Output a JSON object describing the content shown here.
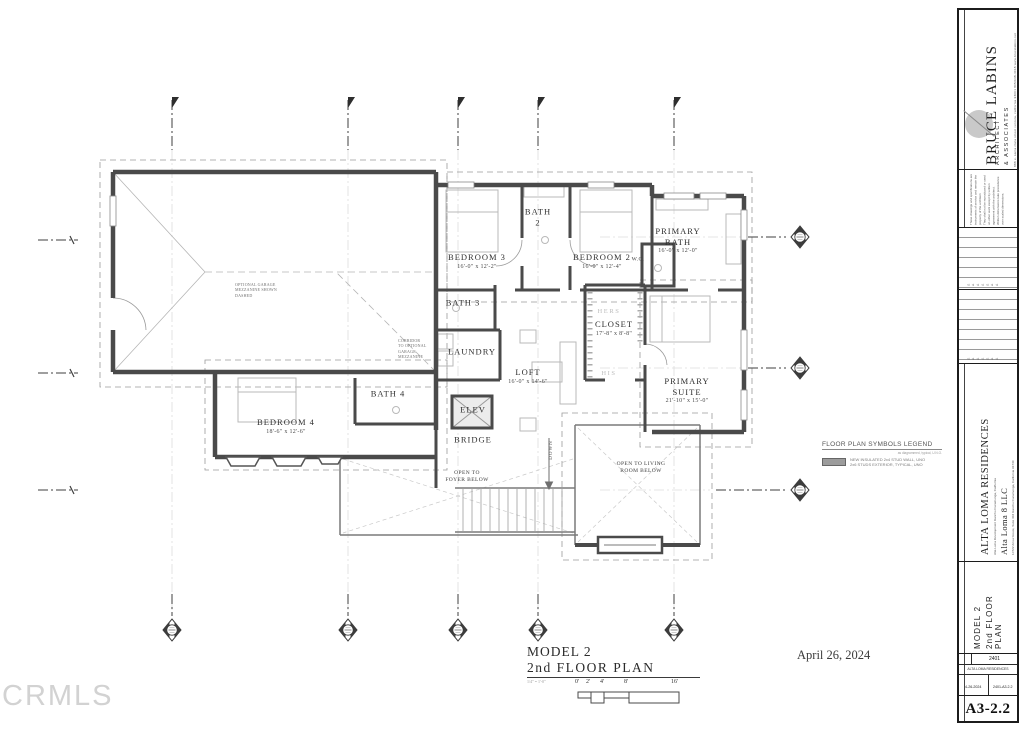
{
  "watermark": "CRMLS",
  "date_note": "April 26, 2024",
  "drawing_title": {
    "line1": "MODEL 2",
    "line2": "2nd FLOOR PLAN",
    "scale_note": "1/4\" = 1'-0\"",
    "scale_ticks": [
      "0'",
      "2'",
      "4'",
      "8'",
      "16'"
    ]
  },
  "legend": {
    "title": "FLOOR PLAN SYMBOLS LEGEND",
    "note": "as diagrammed, typical, U.N.O.",
    "items": [
      {
        "symbol": "wall-swatch",
        "desc": "NEW INSULATED 2x4 STUD WALL, UNO\n2x6 STUDS EXTERIOR, TYPICAL, UNO"
      }
    ]
  },
  "plan": {
    "rooms": [
      {
        "label": "BEDROOM  3",
        "dims": "16'-0\" x 12'-2\""
      },
      {
        "label": "BATH\n2"
      },
      {
        "label": "BEDROOM  2",
        "dims": "16'-0\" x 12'-4\""
      },
      {
        "label": "PRIMARY\nBATH",
        "dims": "16'-0\" x 12'-0\""
      },
      {
        "label": "W.C."
      },
      {
        "label": "BATH  3"
      },
      {
        "label": "LAUNDRY"
      },
      {
        "label": "HERS"
      },
      {
        "label": "CLOSET",
        "dims": "17'-8\" x 8'-8\""
      },
      {
        "label": "HIS"
      },
      {
        "label": "LOFT",
        "dims": "16'-0\" x 14'-6\""
      },
      {
        "label": "PRIMARY\nSUITE",
        "dims": "21'-10\" x 15'-0\""
      },
      {
        "label": "BEDROOM  4",
        "dims": "18'-6\" x 12'-6\""
      },
      {
        "label": "BATH  4"
      },
      {
        "label": "ELEV"
      },
      {
        "label": "BRIDGE"
      },
      {
        "label": "DOWN"
      },
      {
        "label": "OPEN TO\nFOYER BELOW"
      },
      {
        "label": "OPEN TO LIVING\nROOM BELOW"
      },
      {
        "label": "OPTIONAL GARAGE\nMEZZANINE SHOWN\nDASHED"
      },
      {
        "label": "CORRIDOR\nTO OPTIONAL\nGARAGE\nMEZZANINE"
      }
    ]
  },
  "titleblock": {
    "firm_name": "BRUCE LABINS",
    "firm_sub": "ARCHITECT\n& ASSOCIATES",
    "firm_address": "888 e. santa clara street    ventura, california 93001    805/648-4018    www.brucelabins.net",
    "disclaimer": "These drawings and specifications are instruments of service and remain the property of the architect.\nThey shall not be reproduced or used on other work except by written agreement with the architect.\nWritten dimensions take precedence over scaled dimensions.",
    "project_name": "ALTA LOMA  RESIDENCES",
    "project_sub": "Alta Loma Development      Rancho Cucamonga, California",
    "client_name": "Alta Loma 8 LLC",
    "client_address": "10722 Arrow Route, Suite 304      Rancho Cucamonga, California 91730",
    "sheet_title_line1": "MODEL 2",
    "sheet_title_line2": "2nd FLOOR PLAN",
    "job_number": "2401",
    "project_short": "ALTA LOMA RESIDENCES",
    "date_value": "4-26-2024",
    "file_value": "2401-A3.2.2",
    "sheet_number": "A3-2.2"
  },
  "colors": {
    "wall": "#4a4a4a",
    "thin_line": "#9a9a9a",
    "furniture": "#b9b9b9",
    "label": "#2f2f2f",
    "muted_label": "#bdbdbd",
    "watermark": "#d2d2d2"
  }
}
